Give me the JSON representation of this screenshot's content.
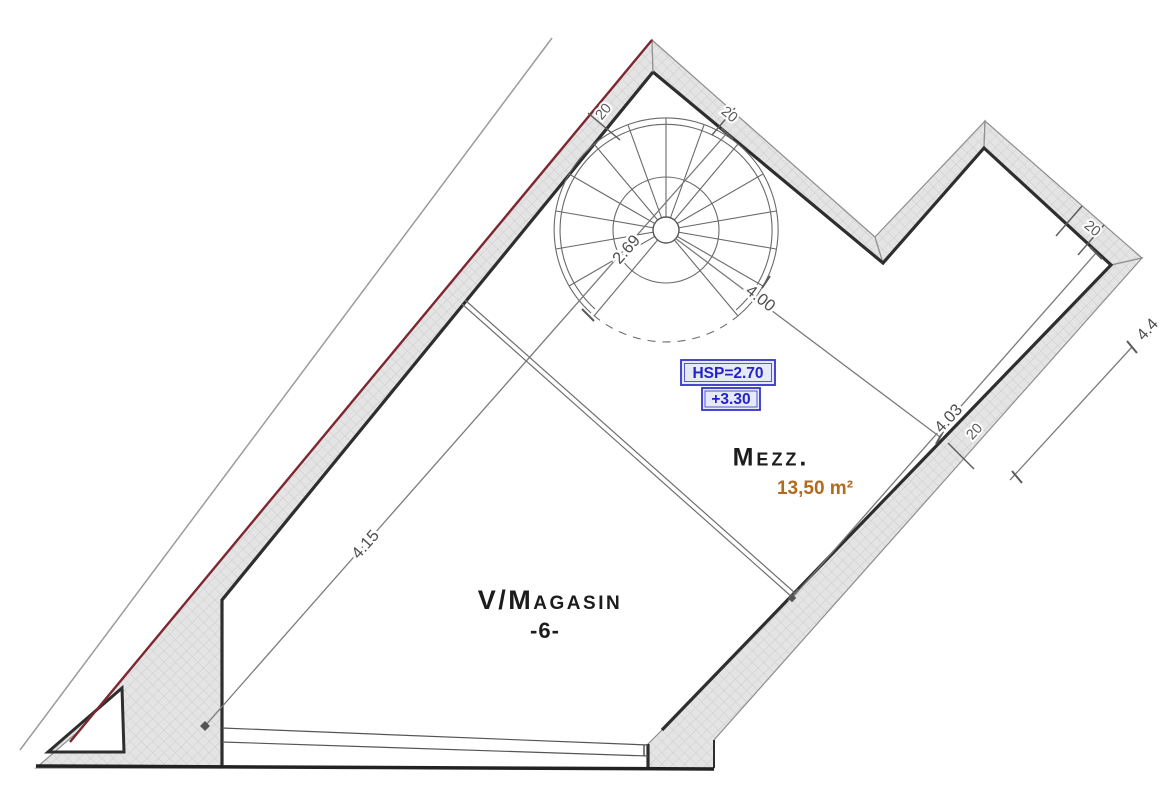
{
  "rooms": {
    "magasin": {
      "name": "V/Magasin",
      "number": "-6-"
    },
    "mezzanine": {
      "name": "Mezz.",
      "area": "13,50 m²"
    }
  },
  "annotations": {
    "ceiling_height": "HSP=2.70",
    "level": "+3.30"
  },
  "dimensions": {
    "magasin_length": "4.15",
    "stair_width": "2.69",
    "mezz_width": "4.00",
    "mezz_length": "4.03",
    "exterior_right": "4.4",
    "wall_thickness_upper_left": "20",
    "wall_thickness_upper_right": "20",
    "wall_thickness_right_corner": "20",
    "wall_thickness_lower_right": "20"
  },
  "colors": {
    "wall_outer_red": "#7d2831",
    "wall_fill": "#e4e4e4",
    "blue_annotation": "#2323c6",
    "area_orange": "#b26a1e",
    "dimension_gray": "#4f4f4f"
  }
}
